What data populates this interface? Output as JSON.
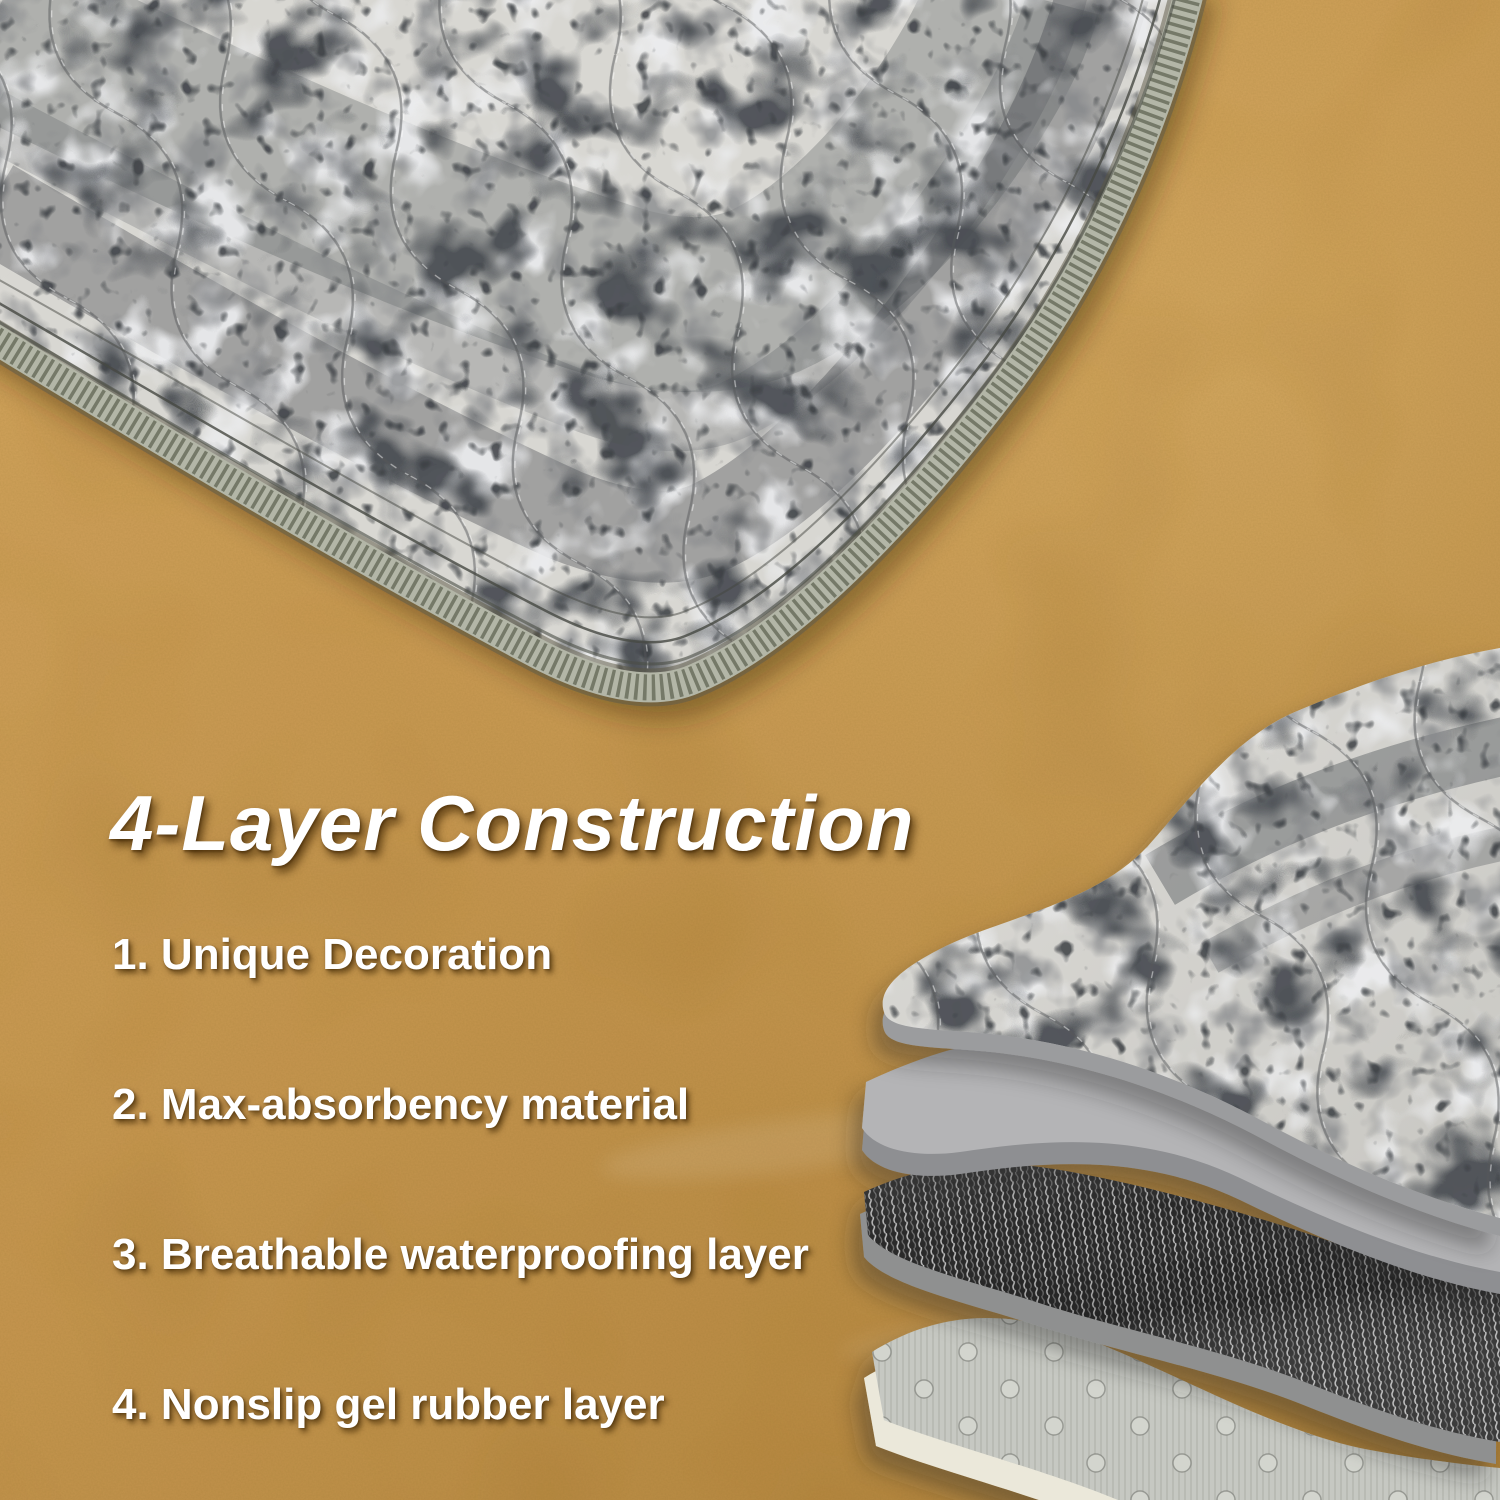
{
  "title": "4-Layer Construction",
  "construction_list": {
    "items": [
      {
        "text": "1. Unique Decoration"
      },
      {
        "text": "2. Max-absorbency material"
      },
      {
        "text": "3. Breathable waterproofing layer"
      },
      {
        "text": "4. Nonslip gel rubber layer"
      }
    ]
  },
  "diagram": {
    "layer_names": [
      "printed-fabric-layer",
      "absorbent-core-layer",
      "waterproof-weave-layer",
      "nonslip-gel-layer"
    ]
  },
  "colors": {
    "floor_light": "#c7964e",
    "floor_mid": "#b5823a",
    "floor_dark": "#9a6a22",
    "text": "#ffffff",
    "fabric_base": "#d8d7d2",
    "fabric_deep": "#c7c6c1",
    "pattern_dark": "#4c5055",
    "pattern_mid": "#85878a",
    "pattern_white": "#edeef0",
    "pattern_speck": "#3d4145",
    "binding_base": "#b3b6a7",
    "binding_stitch": "#747968",
    "fabric_underside": "#9b9c9e",
    "absorbent_gray": "#b4b4b6",
    "absorbent_edge": "#8e8f92",
    "weave_dark": "#2b2b2b",
    "weave_light": "#cfcfcf",
    "nonslip_gray": "#c6c8c2",
    "nonslip_dot": "#d3d5ce",
    "backing_cream": "#ebe8da"
  }
}
